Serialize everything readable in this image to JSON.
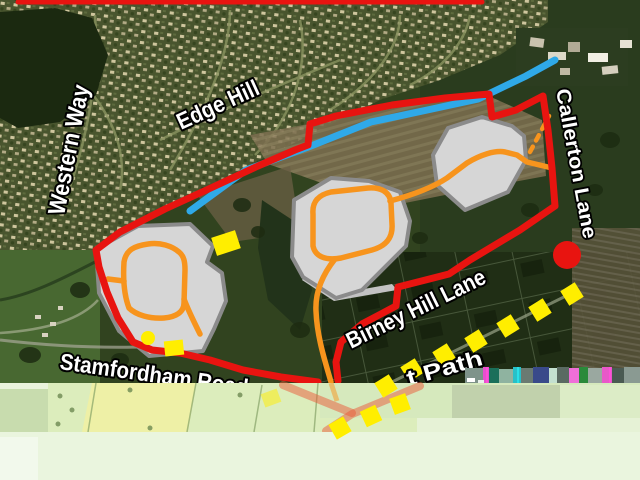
{
  "map": {
    "kind": "aerial-development-masterplan",
    "road_labels": [
      {
        "id": "western-way",
        "text": "Western Way"
      },
      {
        "id": "edge-hill",
        "text": "Edge Hill"
      },
      {
        "id": "callerton-lane",
        "text": "Callerton Lane"
      },
      {
        "id": "birney-hill-lane",
        "text": "Birney Hill Lane"
      },
      {
        "id": "stamfordham-road",
        "text": "Stamfordham Road"
      },
      {
        "id": "path",
        "text": "t Path"
      }
    ],
    "colors": {
      "site_boundary_red": "#e81410",
      "blue_route": "#2fa9e8",
      "access_road_orange": "#f7941d",
      "marker_yellow": "#ffee00",
      "parcel_fill": "#d6d6d6",
      "parcel_border": "#8b8b8b",
      "red_circle_marker": "#e81410"
    },
    "features": {
      "development_parcels": 3,
      "red_circle_markers": 1,
      "yellow_square_markers": 13,
      "yellow_dot_markers": 1
    }
  }
}
